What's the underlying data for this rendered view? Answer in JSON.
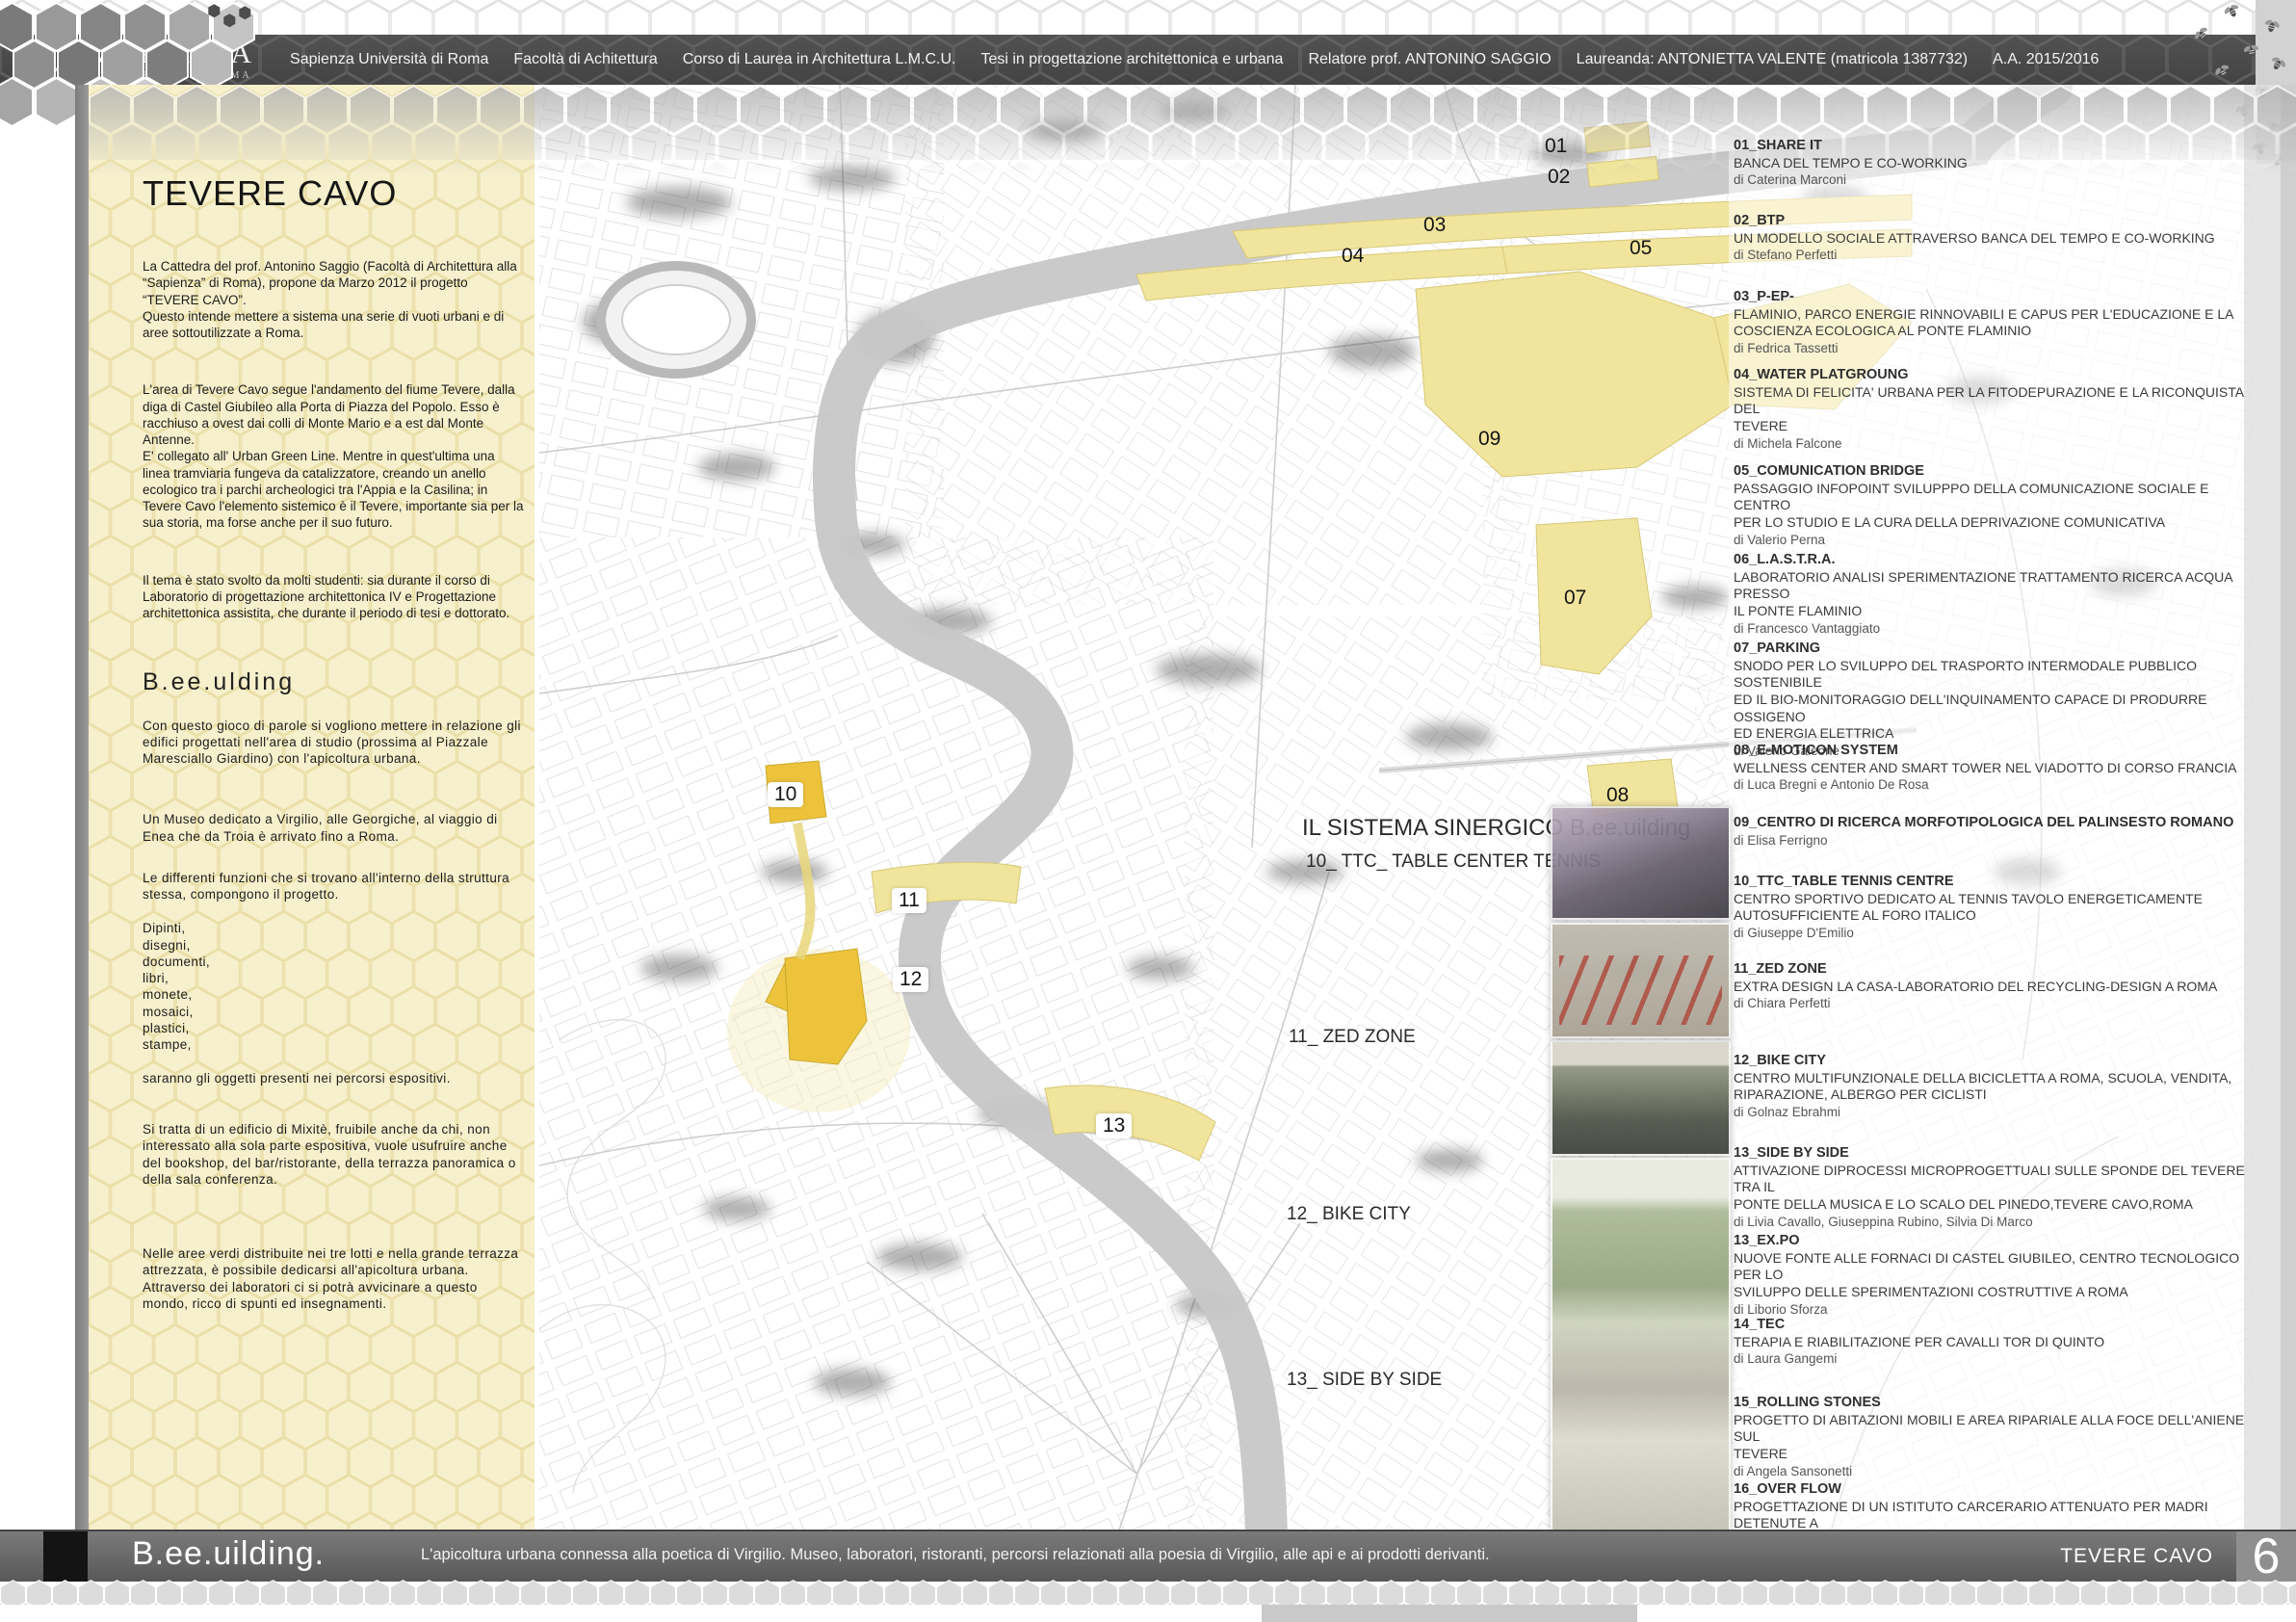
{
  "header": {
    "logo_name": "SAPIENZA",
    "logo_sub": "UNIVERSITÀ DI ROMA",
    "caption_segments": [
      "Sapienza Università di Roma",
      "Facoltà di Achitettura",
      "Corso di Laurea in Architettura L.M.C.U.",
      "Tesi in progettazione architettonica e urbana",
      "Relatore prof. ANTONINO SAGGIO",
      "Laureanda: ANTONIETTA VALENTE (matricola 1387732)",
      "A.A. 2015/2016"
    ]
  },
  "left_panel": {
    "title": "TEVERE CAVO",
    "paragraphs": [
      "La Cattedra del prof. Antonino Saggio (Facoltà di Architettura alla “Sapienza” di Roma), propone da Marzo 2012 il progetto “TEVERE CAVO”.\nQuesto intende mettere a sistema una serie di vuoti urbani e di aree sottoutilizzate a Roma.",
      "L'area di Tevere Cavo segue l'andamento del fiume Tevere, dalla diga di Castel Giubileo alla Porta di Piazza del Popolo. Esso è racchiuso a ovest dai colli di Monte Mario e a est dal Monte Antenne.\nE' collegato all' Urban Green Line. Mentre in quest'ultima una linea tramviaria fungeva da catalizzatore, creando un anello ecologico tra i parchi archeologici tra l'Appia e la Casilina; in Tevere Cavo l'elemento sistemico è il Tevere, importante sia per la sua storia, ma forse anche per il suo futuro.",
      "Il tema è stato svolto da molti studenti: sia durante il corso di Laboratorio di progettazione architettonica IV e Progettazione architettonica assistita, che durante il periodo di tesi e dottorato."
    ],
    "subtitle": "B.ee.ulding",
    "paragraphs2": [
      "Con questo gioco di parole si vogliono mettere in relazione gli edifici progettati nell'area di studio (prossima al Piazzale Maresciallo Giardino) con l'apicoltura urbana.",
      "Un Museo dedicato a Virgilio, alle Georgiche, al viaggio di Enea che da Troia è arrivato fino a Roma.",
      "Le differenti funzioni che si trovano all'interno della struttura stessa, compongono il progetto.",
      "Dipinti,\ndisegni,\ndocumenti,\nlibri,\nmonete,\nmosaici,\nplastici,\nstampe,\n\nsaranno gli oggetti presenti nei percorsi espositivi.",
      "Si tratta di un edificio di Mixitè, fruibile anche da chi, non interessato alla sola parte espositiva, vuole usufruire anche del bookshop, del bar/ristorante, della terrazza panoramica o della sala conferenza.",
      "Nelle aree verdi distribuite nei tre lotti e nella grande terrazza attrezzata, è possibile dedicarsi all'apicoltura urbana.\nAttraverso dei laboratori ci si potrà avvicinare a questo mondo, ricco di spunti ed insegnamenti."
    ]
  },
  "map": {
    "markers": [
      {
        "label": "01"
      },
      {
        "label": "02"
      },
      {
        "label": "03"
      },
      {
        "label": "04"
      },
      {
        "label": "05"
      },
      {
        "label": "09"
      },
      {
        "label": "07"
      },
      {
        "label": "08"
      },
      {
        "label": "10"
      },
      {
        "label": "11"
      },
      {
        "label": "12"
      },
      {
        "label": "13"
      }
    ],
    "area_labels": [
      {
        "label": "IL SISTEMA SINERGICO B.ee.uilding"
      },
      {
        "label": "10_  TTC_ TABLE CENTER TENNIS"
      },
      {
        "label": "11_ ZED ZONE"
      },
      {
        "label": "12_ BIKE CITY"
      },
      {
        "label": "13_ SIDE BY SIDE"
      }
    ]
  },
  "projects": [
    {
      "code": "01_SHARE IT",
      "desc": "BANCA DEL TEMPO E CO-WORKING",
      "author": "di Caterina Marconi"
    },
    {
      "code": "02_BTP",
      "desc": "UN MODELLO SOCIALE ATTRAVERSO BANCA DEL TEMPO E CO-WORKING",
      "author": "di Stefano Perfetti"
    },
    {
      "code": "03_P-EP-",
      "desc": "FLAMINIO, PARCO ENERGIE RINNOVABILI E CAPUS PER L'EDUCAZIONE E LA\nCOSCIENZA ECOLOGICA AL PONTE FLAMINIO",
      "author": "di Fedrica Tassetti"
    },
    {
      "code": "04_WATER PLATGROUNG",
      "desc": "SISTEMA DI FELICITA' URBANA PER LA FITODEPURAZIONE E LA RICONQUISTA DEL\nTEVERE",
      "author": "di Michela Falcone"
    },
    {
      "code": "05_COMUNICATION BRIDGE",
      "desc": "PASSAGGIO INFOPOINT SVILUPPPO DELLA COMUNICAZIONE SOCIALE E CENTRO\nPER LO STUDIO E LA CURA DELLA DEPRIVAZIONE COMUNICATIVA",
      "author": "di Valerio Perna"
    },
    {
      "code": "06_L.A.S.T.R.A.",
      "desc": "LABORATORIO ANALISI SPERIMENTAZIONE TRATTAMENTO RICERCA ACQUA PRESSO\nIL PONTE FLAMINIO",
      "author": "di Francesco Vantaggiato"
    },
    {
      "code": "07_PARKING",
      "desc": "SNODO PER LO SVILUPPO DEL TRASPORTO INTERMODALE PUBBLICO SOSTENIBILE\nED IL BIO-MONITORAGGIO DELL'INQUINAMENTO CAPACE DI PRODURRE OSSIGENO\nED ENERGIA ELETTRICA",
      "author": "di Valerio Galeone"
    },
    {
      "code": "08_E-MOTICON SYSTEM",
      "desc": "WELLNESS CENTER AND SMART TOWER NEL VIADOTTO DI CORSO FRANCIA",
      "author": "di Luca Bregni e Antonio De Rosa"
    },
    {
      "code": "09_CENTRO DI RICERCA MORFOTIPOLOGICA DEL PALINSESTO ROMANO",
      "desc": "",
      "author": "di Elisa Ferrigno"
    },
    {
      "code": "10_TTC_TABLE TENNIS CENTRE",
      "desc": "CENTRO SPORTIVO DEDICATO AL TENNIS TAVOLO ENERGETICAMENTE\nAUTOSUFFICIENTE AL FORO ITALICO",
      "author": "di Giuseppe D'Emilio"
    },
    {
      "code": "11_ZED ZONE",
      "desc": "EXTRA DESIGN LA CASA-LABORATORIO DEL RECYCLING-DESIGN A ROMA",
      "author": "di Chiara Perfetti"
    },
    {
      "code": "12_BIKE CITY",
      "desc": "CENTRO MULTIFUNZIONALE DELLA BICICLETTA A ROMA, SCUOLA, VENDITA,\nRIPARAZIONE, ALBERGO PER CICLISTI",
      "author": "di Golnaz Ebrahmi"
    },
    {
      "code": "13_SIDE BY SIDE",
      "desc": "ATTIVAZIONE DIPROCESSI MICROPROGETTUALI SULLE SPONDE DEL TEVERE TRA IL\nPONTE DELLA MUSICA E LO SCALO DEL PINEDO,TEVERE CAVO,ROMA",
      "author": "di Livia Cavallo, Giuseppina Rubino, Silvia Di Marco"
    },
    {
      "code": "13_EX.PO",
      "desc": "NUOVE FONTE ALLE FORNACI DI CASTEL GIUBILEO, CENTRO TECNOLOGICO PER LO\nSVILUPPO DELLE SPERIMENTAZIONI COSTRUTTIVE A ROMA",
      "author": "di Liborio Sforza"
    },
    {
      "code": "14_TEC",
      "desc": "TERAPIA E RIABILITAZIONE PER CAVALLI TOR DI QUINTO",
      "author": "di Laura Gangemi"
    },
    {
      "code": "15_ROLLING STONES",
      "desc": "PROGETTO DI ABITAZIONI MOBILI E AREA RIPARIALE ALLA FOCE DELL'ANIENE SUL\nTEVERE",
      "author": "di Angela Sansonetti"
    },
    {
      "code": "16_OVER FLOW",
      "desc": "PROGETTAZIONE DI UN ISTITUTO CARCERARIO ATTENUATO PER MADRI DETENUTE A\nPORTA DEL POPOLO",
      "author": ""
    }
  ],
  "footer": {
    "brand": "B.ee.uilding.",
    "tagline": "L'apicoltura urbana connessa alla poetica di Virgilio. Museo, laboratori, ristoranti, percorsi relazionati alla poesia di Virgilio, alle api e ai prodotti derivanti.",
    "section": "TEVERE CAVO",
    "page": "6"
  },
  "colors": {
    "cream": "#f7f0cd",
    "zone_yellow": "#f1e49c",
    "zone_bright": "#edc33c",
    "bar_gray": "#5a5a5a",
    "river_gray": "#c7c7c7"
  }
}
